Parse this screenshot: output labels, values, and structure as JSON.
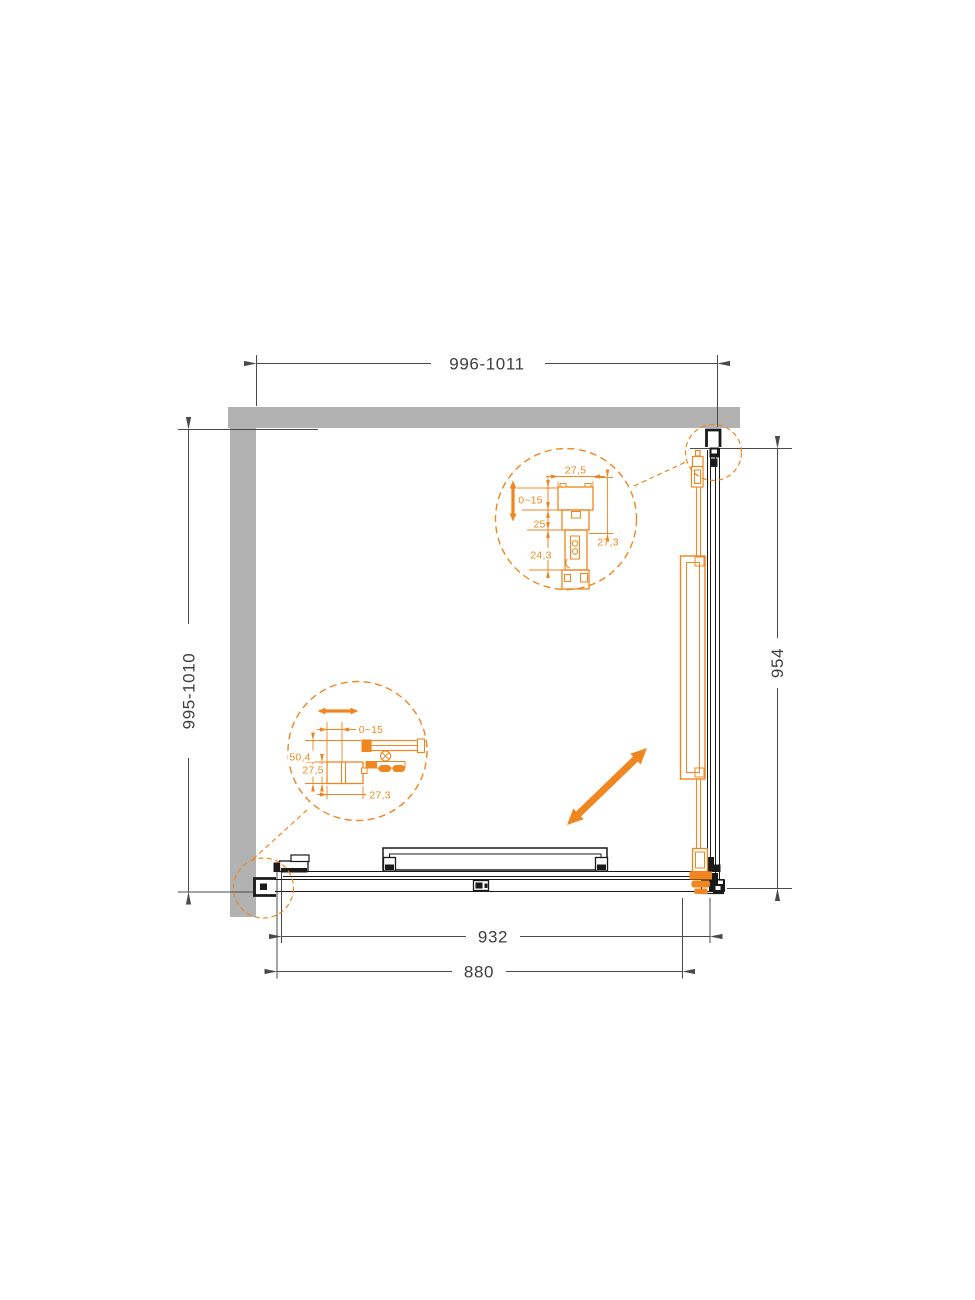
{
  "drawing": {
    "dim_width_top": "996-1011",
    "dim_depth_left": "995-1010",
    "dim_depth_right": "954",
    "dim_track_bottom": "932",
    "dim_door_bottom": "880"
  },
  "detail_top": {
    "dim_profile_width": "27,5",
    "dim_adjustment": "0~15",
    "dim_inner": "25",
    "dim_lower": "24,3",
    "dim_total": "27,3"
  },
  "detail_bottom": {
    "dim_adjustment": "0~15",
    "dim_total": "50,4",
    "dim_profile": "27,5",
    "dim_width": "27,3"
  },
  "colors": {
    "accent_orange": "#F0861F",
    "wall_gray": "#B2B2B2",
    "line_black": "#1A1A1A",
    "dim_gray": "#4A4A4C"
  }
}
